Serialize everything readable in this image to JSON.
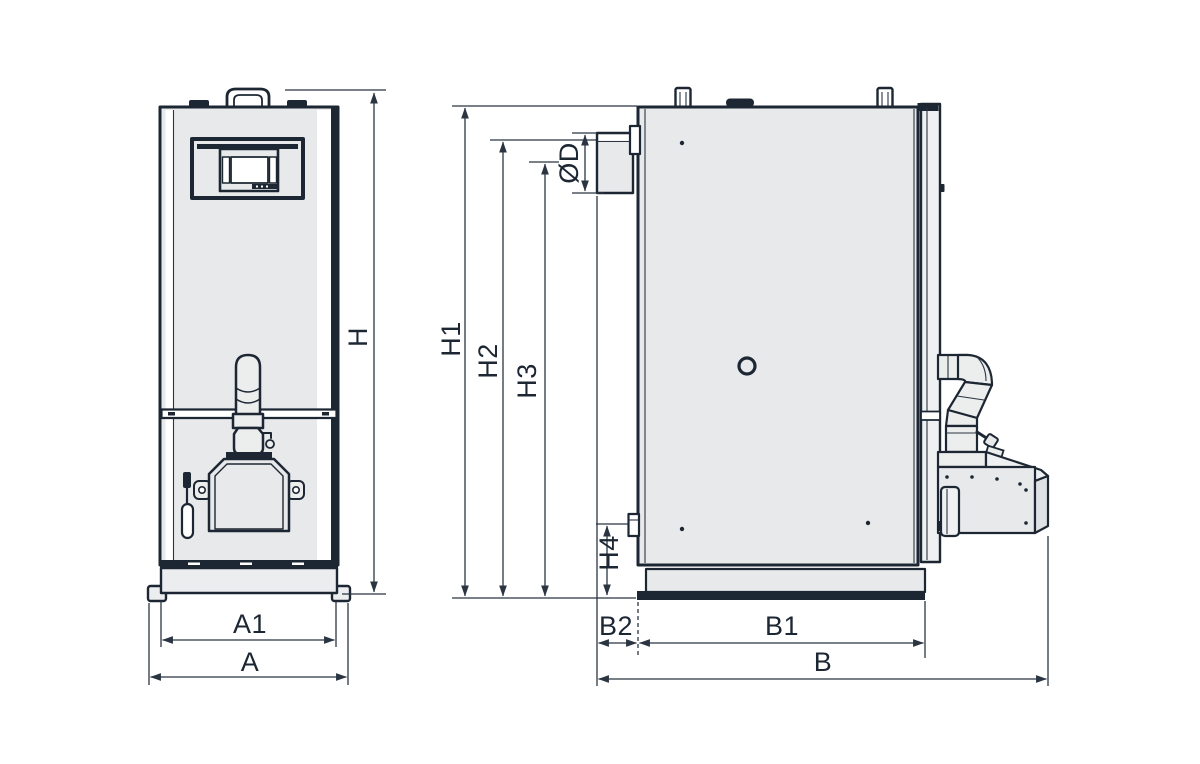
{
  "diagram": {
    "subject": "Pellet boiler technical dimension drawing, front and side views",
    "colors": {
      "outline": "#1d2733",
      "body_fill": "#e8e9eb",
      "dimension_lines": "#2b3542",
      "label_text": "#1d2733",
      "background": "#ffffff"
    },
    "front_view": {
      "title": "front view",
      "dims": {
        "height_overall": "H",
        "width_base_inner": "A1",
        "width_overall": "A"
      }
    },
    "side_view": {
      "title": "side view",
      "dims": {
        "height_top": "H1",
        "height_flue_top": "H2",
        "height_flue_center": "H3",
        "height_return": "H4",
        "flue_diameter": "ØD",
        "depth_flue_offset": "B2",
        "depth_body": "B1",
        "depth_overall": "B"
      }
    }
  }
}
